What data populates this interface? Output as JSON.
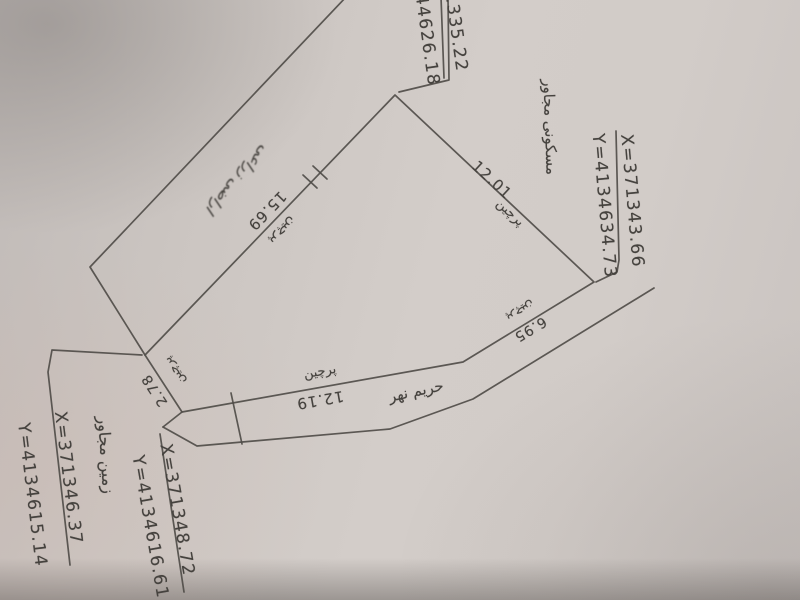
{
  "corner_points": {
    "top_left_partial": {
      "x_partial": "1335.22",
      "y_partial": "44626.18"
    },
    "right": {
      "x": "X=371343.66",
      "y": "Y=4134634.73"
    },
    "bottom_outer": {
      "x": "X=371346.37",
      "y": "Y=4134615.14"
    },
    "bottom_inner": {
      "x": "X=371348.72",
      "y": "Y=4134616.61"
    }
  },
  "labels": {
    "adjacent_residential": "مسکونی مجاور",
    "adjacent_land": "زمین مجاور",
    "stream_buffer": "حریم نهر",
    "handwritten_note": "اراضی زراعی"
  },
  "sides": [
    {
      "name": "side-12-01",
      "length": "12.01",
      "fence": "پرچین"
    },
    {
      "name": "side-6-95",
      "length": "6.95",
      "fence": "پرچین"
    },
    {
      "name": "side-12-19",
      "length": "12.19",
      "fence": "پرچین"
    },
    {
      "name": "side-2-78",
      "length": "2.78",
      "fence": "پرچین"
    },
    {
      "name": "side-15-69",
      "length": "15.69",
      "fence": "پرچین"
    }
  ]
}
